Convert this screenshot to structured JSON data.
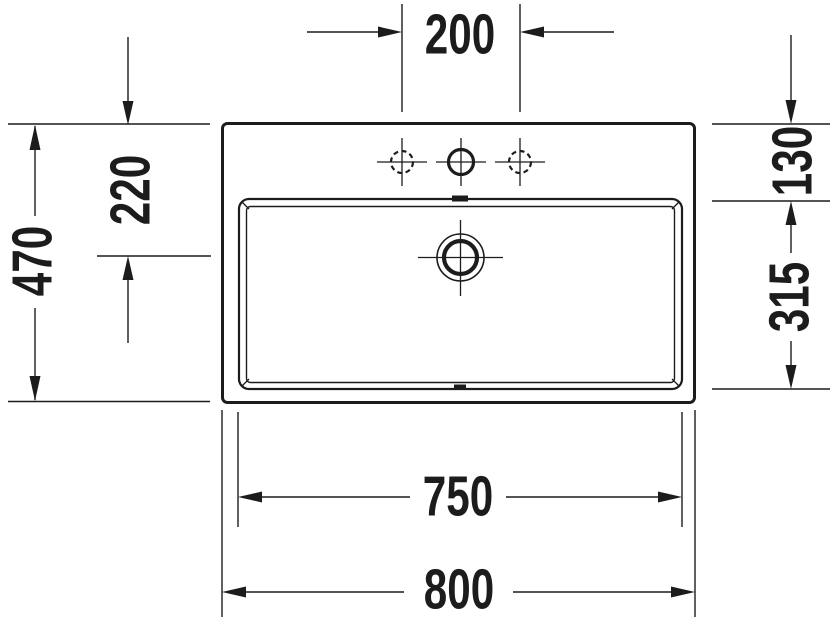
{
  "drawing": {
    "type": "technical-dimension-drawing",
    "subject": "washbasin-top-view",
    "background_color": "#ffffff",
    "line_color": "#1c1c1c"
  },
  "dimensions": [
    {
      "id": "faucet-hole-spacing",
      "value": "200",
      "orientation": "horizontal"
    },
    {
      "id": "overall-depth",
      "value": "470",
      "orientation": "vertical"
    },
    {
      "id": "top-edge-to-drain-center",
      "value": "220",
      "orientation": "vertical"
    },
    {
      "id": "top-edge-to-basin-rim",
      "value": "130",
      "orientation": "vertical"
    },
    {
      "id": "basin-inner-depth",
      "value": "315",
      "orientation": "vertical"
    },
    {
      "id": "basin-inner-width",
      "value": "750",
      "orientation": "horizontal"
    },
    {
      "id": "overall-width",
      "value": "800",
      "orientation": "horizontal"
    }
  ]
}
